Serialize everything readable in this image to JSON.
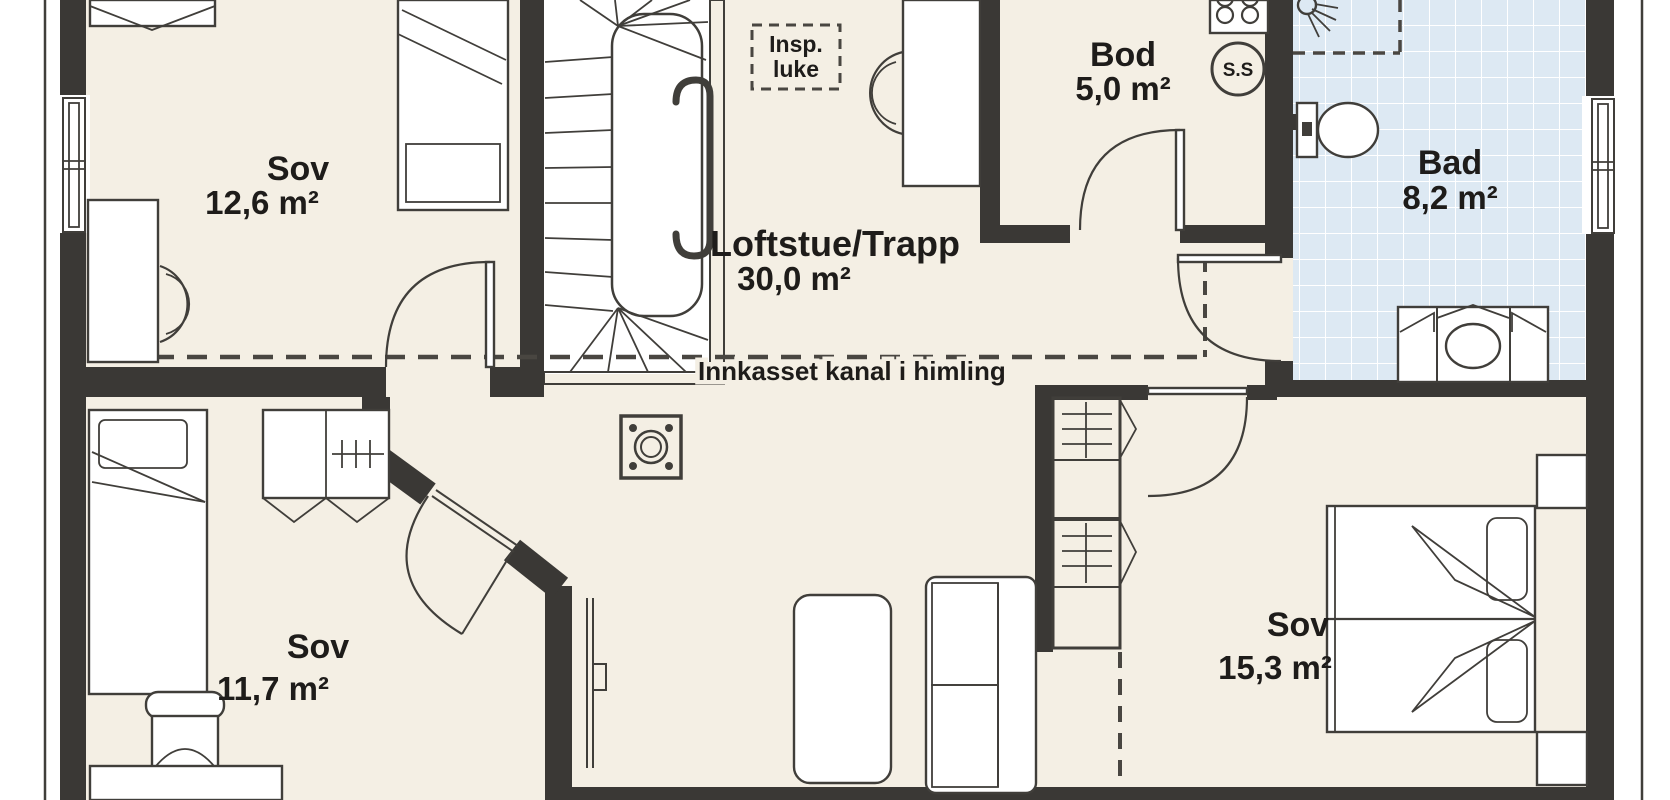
{
  "title": "Loft floor plan",
  "colors": {
    "wall": "#3a3835",
    "line": "#403e3a",
    "floor": "#f4efe4",
    "tile": "#dde9f3",
    "tileLine": "#ffffff",
    "text": "#1e1c1a",
    "dash": "#494641",
    "outside": "#ffffff"
  },
  "rooms": [
    {
      "id": "sov-1",
      "name": "Sov",
      "area": "12,6 m²"
    },
    {
      "id": "loftstue",
      "name": "Loftstue/Trapp",
      "area": "30,0 m²"
    },
    {
      "id": "bod",
      "name": "Bod",
      "area": "5,0 m²"
    },
    {
      "id": "bad",
      "name": "Bad",
      "area": "8,2 m²"
    },
    {
      "id": "sov-2",
      "name": "Sov",
      "area": "11,7 m²"
    },
    {
      "id": "sov-3",
      "name": "Sov",
      "area": "15,3 m²"
    }
  ],
  "annotations": {
    "inspection_hatch_line1": "Insp.",
    "inspection_hatch_line2": "luke",
    "ceiling_duct": "Innkasset kanal i himling",
    "floor_drain": "S.S"
  }
}
